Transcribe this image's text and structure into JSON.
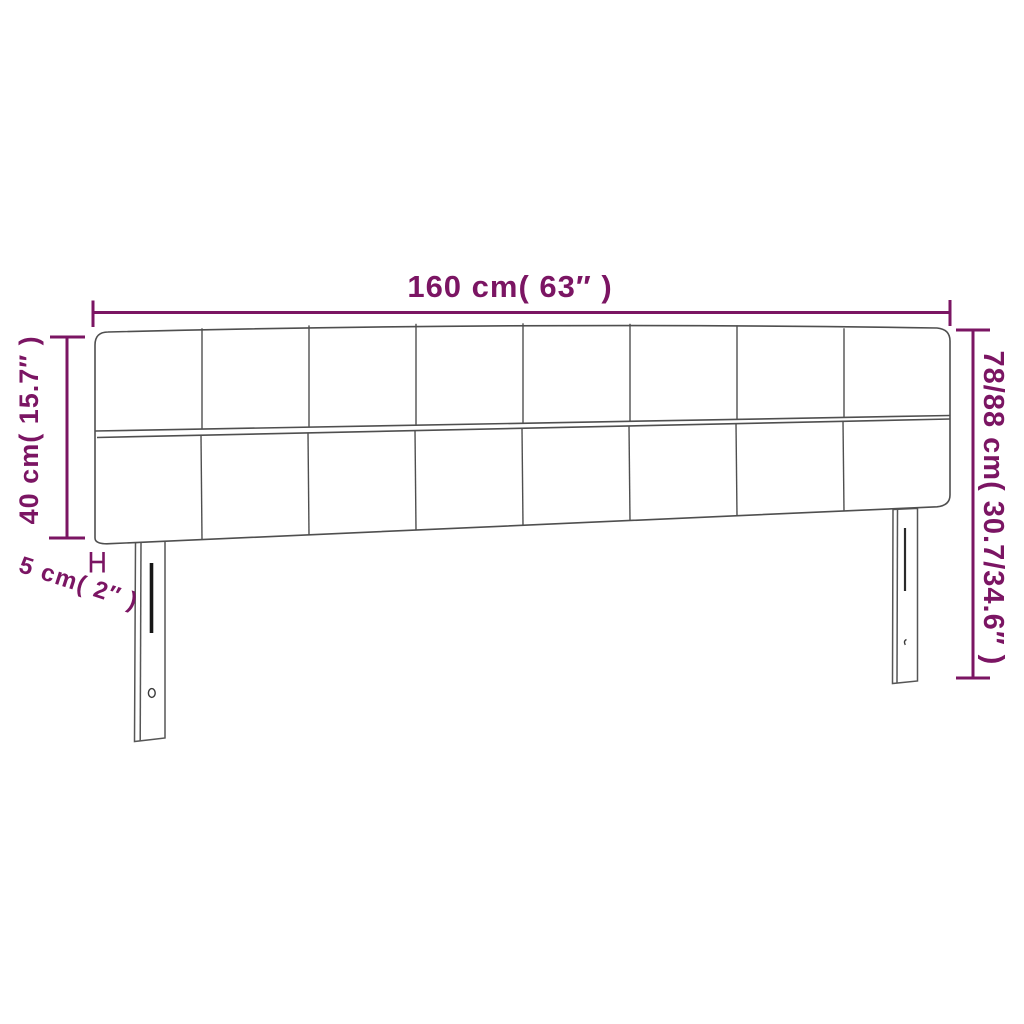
{
  "diagram": {
    "product": "headboard",
    "labels": {
      "width": "160 cm( 63″ )",
      "panel_height": "40 cm( 15.7″ )",
      "total_height": "78/88 cm( 30.7/34.6″ )",
      "leg_thickness": "5 cm( 2″ )"
    },
    "panel_grid": {
      "columns": 8,
      "rows": 2
    },
    "colors": {
      "dimension_accent": "#7b1563",
      "outline_gray": "#4f4f4f",
      "slot_black": "#161616",
      "background": "#ffffff"
    }
  }
}
